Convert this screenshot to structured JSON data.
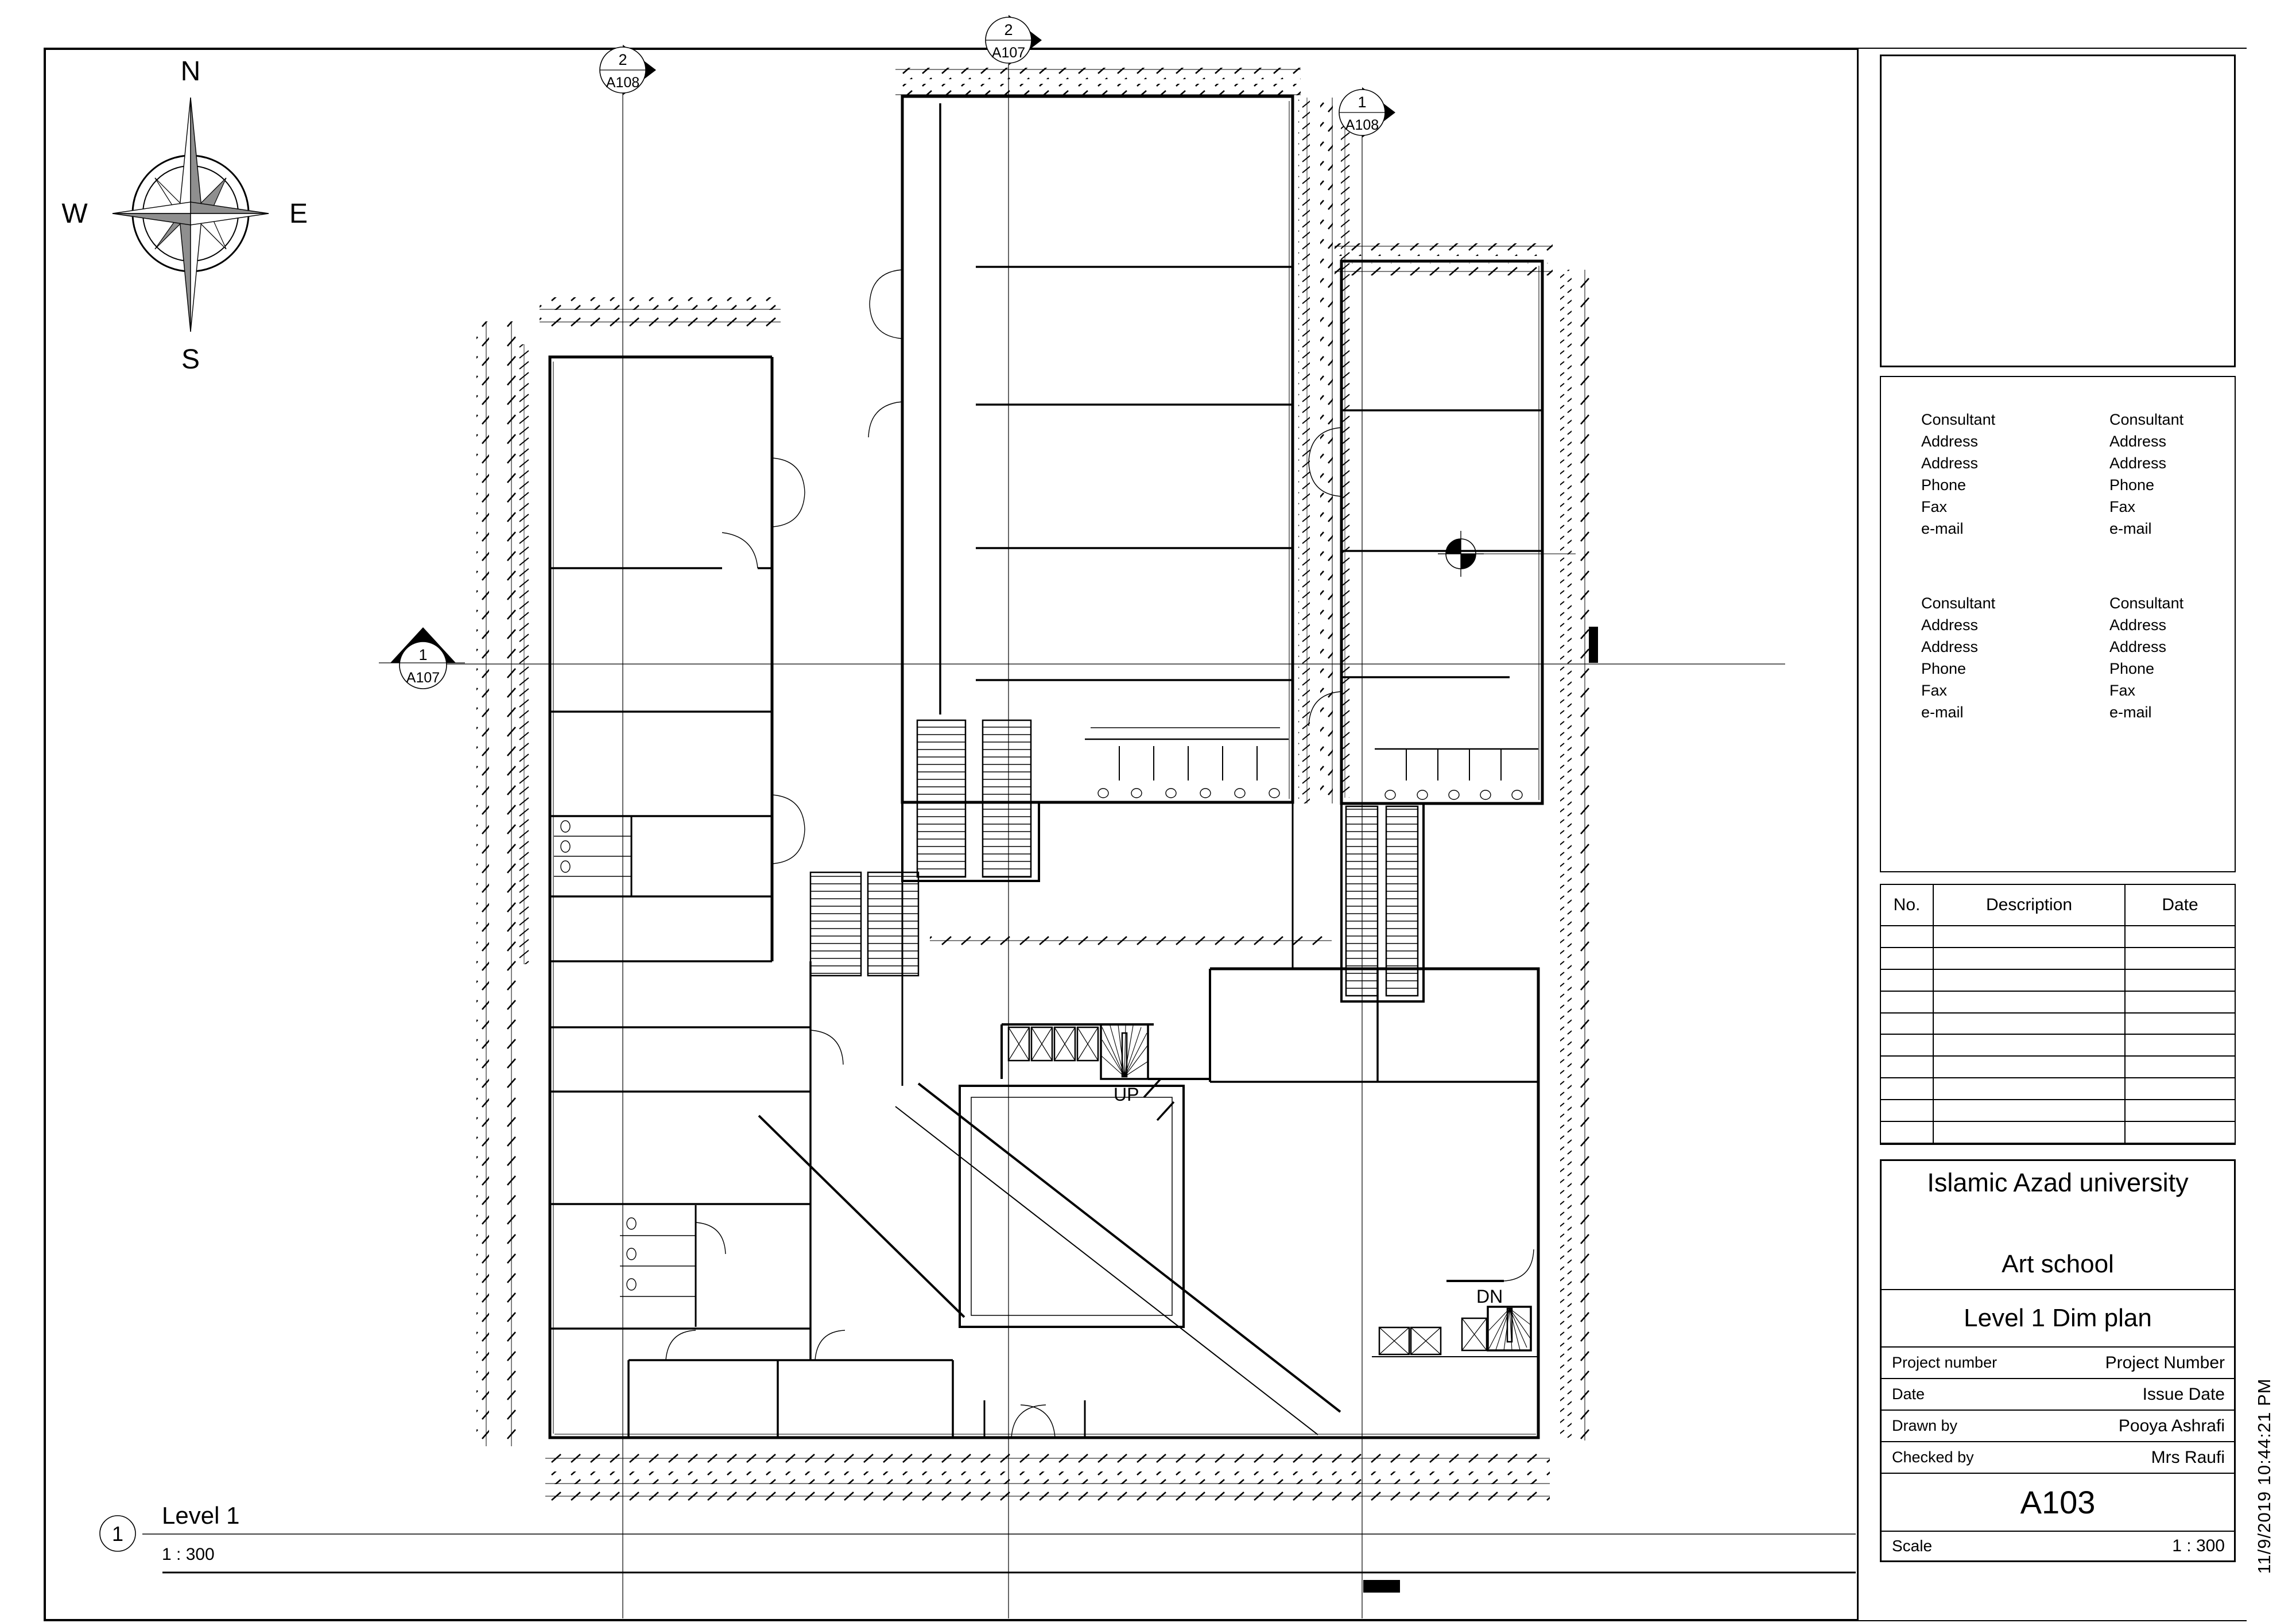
{
  "compass": {
    "north": "N",
    "east": "E",
    "south": "S",
    "west": "W"
  },
  "view_title": {
    "number": "1",
    "name": "Level 1",
    "scale": "1 : 300"
  },
  "plan": {
    "up_label": "UP",
    "dn_label": "DN"
  },
  "markers": {
    "top_left": {
      "detail": "2",
      "sheet": "A108"
    },
    "top_center": {
      "detail": "2",
      "sheet": "A107"
    },
    "top_right": {
      "detail": "1",
      "sheet": "A108"
    },
    "left": {
      "detail": "1",
      "sheet": "A107"
    }
  },
  "title_block": {
    "consultant_lines": [
      "Consultant",
      "Address",
      "Address",
      "Phone",
      "Fax",
      "e-mail"
    ],
    "revision_table": {
      "headers": [
        "No.",
        "Description",
        "Date"
      ],
      "empty_rows": 10
    },
    "project": {
      "client": "Islamic Azad university",
      "project_name": "Art school",
      "sheet_name": "Level 1 Dim plan",
      "fields": [
        {
          "label": "Project number",
          "value": "Project Number"
        },
        {
          "label": "Date",
          "value": "Issue Date"
        },
        {
          "label": "Drawn by",
          "value": "Pooya Ashrafi"
        },
        {
          "label": "Checked by",
          "value": "Mrs Raufi"
        }
      ],
      "sheet_number": "A103",
      "scale_label": "Scale",
      "scale_value": "1 : 300"
    },
    "timestamp": "11/9/2019 10:44:21 PM"
  },
  "colors": {
    "ink": "#000000",
    "compass_fill": "#8f8f8f"
  }
}
